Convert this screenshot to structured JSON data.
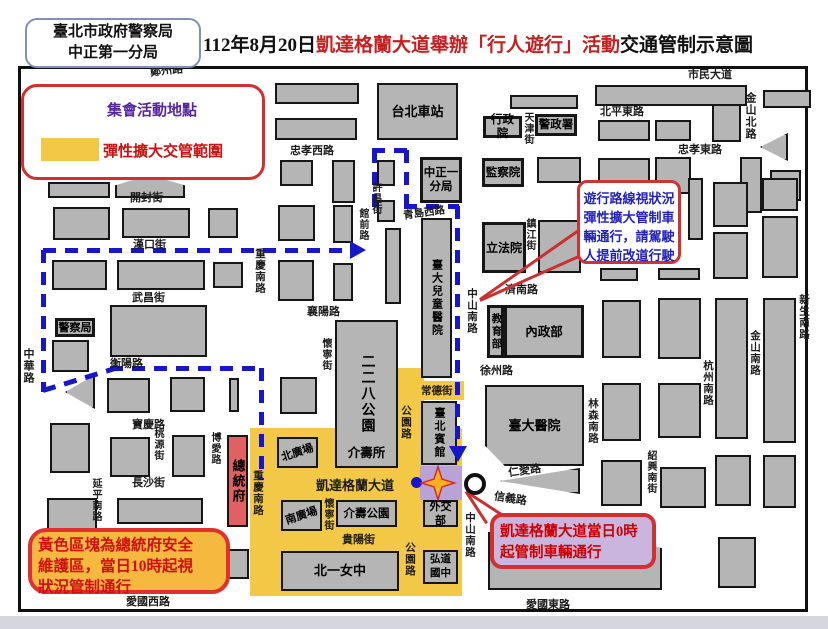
{
  "header": {
    "agency_line1": "臺北市政府警察局",
    "agency_line2": "中正第一分局",
    "title_prefix": "112年8月20日",
    "title_red": "凱達格蘭大道舉辦「行人遊行」活動",
    "title_suffix": "交通管制示意圖"
  },
  "legend": {
    "star_label": "集會活動地點",
    "zone_label": "彈性擴大交管範圍"
  },
  "callouts": {
    "route_note": [
      "遊行路線視狀況",
      "彈性擴大管制車",
      "輛通行，請駕駛",
      "人提前改道行駛"
    ],
    "yellow_note": [
      "黃色區塊為總統府安全",
      "維護區，當日10時起視",
      "狀況管制通行"
    ],
    "kdg_note": [
      "凱達格蘭大道當日0時",
      "起管制車輛通行"
    ]
  },
  "colors": {
    "control_zone_yellow": "#f3c846",
    "assembly_purple": "#b9a3d6",
    "president_red": "#e06161",
    "route_blue": "#1717c9",
    "callout_red": "#cc3333",
    "block_gray": "#b5b5b5"
  },
  "map": {
    "zones": [
      {
        "x": 250,
        "y": 428,
        "w": 212,
        "h": 168,
        "c": "#f3c846"
      },
      {
        "x": 394,
        "y": 368,
        "w": 30,
        "h": 118,
        "c": "#f3c846"
      },
      {
        "x": 420,
        "y": 381,
        "w": 44,
        "h": 19,
        "c": "#f3c846"
      },
      {
        "x": 420,
        "y": 466,
        "w": 42,
        "h": 34,
        "c": "#b9a3d6"
      }
    ],
    "blocks": [
      {
        "x": 48,
        "y": 182,
        "w": 62,
        "h": 16
      },
      {
        "x": 115,
        "y": 175,
        "w": 70,
        "h": 23,
        "kind": "tri-top"
      },
      {
        "x": 53,
        "y": 207,
        "w": 57,
        "h": 33
      },
      {
        "x": 122,
        "y": 208,
        "w": 68,
        "h": 30
      },
      {
        "x": 208,
        "y": 208,
        "w": 30,
        "h": 30
      },
      {
        "x": 52,
        "y": 260,
        "w": 55,
        "h": 30
      },
      {
        "x": 117,
        "y": 260,
        "w": 88,
        "h": 30
      },
      {
        "x": 213,
        "y": 262,
        "w": 30,
        "h": 26
      },
      {
        "x": 110,
        "y": 305,
        "w": 97,
        "h": 52
      },
      {
        "x": 52,
        "y": 340,
        "w": 37,
        "h": 32
      },
      {
        "x": 65,
        "y": 375,
        "w": 30,
        "h": 34,
        "kind": "tri-left"
      },
      {
        "x": 107,
        "y": 378,
        "w": 43,
        "h": 35
      },
      {
        "x": 170,
        "y": 377,
        "w": 35,
        "h": 35
      },
      {
        "x": 229,
        "y": 378,
        "w": 10,
        "h": 34
      },
      {
        "x": 50,
        "y": 423,
        "w": 40,
        "h": 50
      },
      {
        "x": 110,
        "y": 437,
        "w": 40,
        "h": 40
      },
      {
        "x": 172,
        "y": 435,
        "w": 33,
        "h": 42
      },
      {
        "x": 47,
        "y": 498,
        "w": 50,
        "h": 34
      },
      {
        "x": 117,
        "y": 498,
        "w": 86,
        "h": 26
      },
      {
        "x": 50,
        "y": 542,
        "w": 58,
        "h": 48
      },
      {
        "x": 120,
        "y": 532,
        "w": 84,
        "h": 54
      },
      {
        "x": 223,
        "y": 549,
        "w": 26,
        "h": 30
      },
      {
        "x": 275,
        "y": 83,
        "w": 84,
        "h": 21
      },
      {
        "x": 275,
        "y": 118,
        "w": 82,
        "h": 22
      },
      {
        "x": 280,
        "y": 160,
        "w": 33,
        "h": 26
      },
      {
        "x": 332,
        "y": 160,
        "w": 23,
        "h": 43
      },
      {
        "x": 377,
        "y": 160,
        "w": 18,
        "h": 26
      },
      {
        "x": 278,
        "y": 205,
        "w": 37,
        "h": 36
      },
      {
        "x": 333,
        "y": 205,
        "w": 20,
        "h": 38
      },
      {
        "x": 377,
        "y": 200,
        "w": 18,
        "h": 22
      },
      {
        "x": 385,
        "y": 228,
        "w": 16,
        "h": 76
      },
      {
        "x": 278,
        "y": 260,
        "w": 36,
        "h": 41
      },
      {
        "x": 333,
        "y": 263,
        "w": 20,
        "h": 38
      },
      {
        "x": 280,
        "y": 377,
        "w": 37,
        "h": 37
      },
      {
        "x": 510,
        "y": 95,
        "w": 68,
        "h": 14
      },
      {
        "x": 595,
        "y": 85,
        "w": 152,
        "h": 21
      },
      {
        "x": 763,
        "y": 90,
        "w": 48,
        "h": 18
      },
      {
        "x": 598,
        "y": 120,
        "w": 52,
        "h": 21
      },
      {
        "x": 655,
        "y": 120,
        "w": 36,
        "h": 21
      },
      {
        "x": 712,
        "y": 104,
        "w": 29,
        "h": 38
      },
      {
        "x": 537,
        "y": 157,
        "w": 44,
        "h": 26
      },
      {
        "x": 598,
        "y": 158,
        "w": 52,
        "h": 36
      },
      {
        "x": 655,
        "y": 157,
        "w": 36,
        "h": 37
      },
      {
        "x": 740,
        "y": 157,
        "w": 22,
        "h": 56
      },
      {
        "x": 770,
        "y": 170,
        "w": 31,
        "h": 31
      },
      {
        "x": 760,
        "y": 133,
        "w": 28,
        "h": 28,
        "kind": "tri-left"
      },
      {
        "x": 538,
        "y": 220,
        "w": 43,
        "h": 53
      },
      {
        "x": 688,
        "y": 178,
        "w": 15,
        "h": 62
      },
      {
        "x": 713,
        "y": 182,
        "w": 35,
        "h": 45
      },
      {
        "x": 762,
        "y": 178,
        "w": 36,
        "h": 33
      },
      {
        "x": 713,
        "y": 232,
        "w": 35,
        "h": 47
      },
      {
        "x": 762,
        "y": 216,
        "w": 36,
        "h": 62
      },
      {
        "x": 600,
        "y": 268,
        "w": 38,
        "h": 13
      },
      {
        "x": 658,
        "y": 268,
        "w": 42,
        "h": 12
      },
      {
        "x": 602,
        "y": 300,
        "w": 39,
        "h": 58
      },
      {
        "x": 658,
        "y": 298,
        "w": 43,
        "h": 61
      },
      {
        "x": 715,
        "y": 298,
        "w": 33,
        "h": 141
      },
      {
        "x": 763,
        "y": 298,
        "w": 33,
        "h": 145
      },
      {
        "x": 602,
        "y": 383,
        "w": 39,
        "h": 58
      },
      {
        "x": 658,
        "y": 383,
        "w": 43,
        "h": 55
      },
      {
        "x": 500,
        "y": 468,
        "w": 80,
        "h": 26,
        "kind": "tri-left"
      },
      {
        "x": 601,
        "y": 460,
        "w": 41,
        "h": 46
      },
      {
        "x": 660,
        "y": 467,
        "w": 46,
        "h": 41
      },
      {
        "x": 715,
        "y": 455,
        "w": 36,
        "h": 51
      },
      {
        "x": 763,
        "y": 455,
        "w": 33,
        "h": 53
      },
      {
        "x": 718,
        "y": 537,
        "w": 38,
        "h": 51
      },
      {
        "x": 488,
        "y": 532,
        "w": 174,
        "h": 58,
        "kind": "cut-tr",
        "label": "堂",
        "lpos": [
          30,
          42
        ]
      },
      {
        "x": 377,
        "y": 83,
        "w": 81,
        "h": 57,
        "label": "台北車站",
        "fs": 13
      },
      {
        "x": 420,
        "y": 157,
        "w": 42,
        "h": 46,
        "label": "中正一\n分局",
        "kind": "gov",
        "fs": 11.5
      },
      {
        "x": 483,
        "y": 116,
        "w": 39,
        "h": 22,
        "label": "行政院",
        "kind": "gov",
        "fs": 11.5
      },
      {
        "x": 535,
        "y": 114,
        "w": 42,
        "h": 22,
        "label": "警政署",
        "kind": "gov",
        "fs": 11.5
      },
      {
        "x": 482,
        "y": 158,
        "w": 42,
        "h": 29,
        "label": "監察院",
        "kind": "gov",
        "fs": 11.5
      },
      {
        "x": 482,
        "y": 222,
        "w": 44,
        "h": 51,
        "label": "立法院",
        "kind": "gov",
        "fs": 12
      },
      {
        "x": 487,
        "y": 305,
        "w": 17,
        "h": 53,
        "label": "教育部",
        "kind": "gov",
        "ls": "v",
        "fs": 10.5
      },
      {
        "x": 504,
        "y": 305,
        "w": 80,
        "h": 53,
        "label": "內政部",
        "kind": "gov",
        "fs": 12.5
      },
      {
        "x": 55,
        "y": 318,
        "w": 40,
        "h": 19,
        "label": "警察局",
        "kind": "gov",
        "fs": 11
      },
      {
        "x": 335,
        "y": 320,
        "w": 63,
        "h": 148,
        "label": "二二八公園",
        "ls": "v",
        "sub": "介壽所",
        "fs": 14
      },
      {
        "x": 421,
        "y": 218,
        "w": 31,
        "h": 160,
        "label": "臺大兒童醫院",
        "ls": "v",
        "fs": 11
      },
      {
        "x": 421,
        "y": 401,
        "w": 36,
        "h": 64,
        "label": "臺北賓館",
        "ls": "v",
        "fs": 11
      },
      {
        "x": 277,
        "y": 437,
        "w": 41,
        "h": 31,
        "label": "北廣場",
        "ls": "rot",
        "fs": 11
      },
      {
        "x": 281,
        "y": 500,
        "w": 41,
        "h": 31,
        "label": "南廣場",
        "ls": "rot",
        "fs": 11
      },
      {
        "x": 336,
        "y": 500,
        "w": 61,
        "h": 27,
        "label": "介壽公園",
        "fs": 11.5
      },
      {
        "x": 423,
        "y": 500,
        "w": 35,
        "h": 27,
        "label": "外交部",
        "fs": 11
      },
      {
        "x": 281,
        "y": 551,
        "w": 118,
        "h": 40,
        "label": "北一女中",
        "fs": 13
      },
      {
        "x": 423,
        "y": 550,
        "w": 35,
        "h": 34,
        "label": "弘道\n國中",
        "fs": 10.5
      },
      {
        "x": 485,
        "y": 385,
        "w": 99,
        "h": 81,
        "label": "臺大醫院",
        "kind": "cut-bl",
        "fs": 13
      },
      {
        "x": 227,
        "y": 435,
        "w": 21,
        "h": 92,
        "label": "總統府",
        "kind": "pres",
        "ls": "v",
        "fs": 13
      }
    ],
    "streets": [
      {
        "t": "鄭州路",
        "x": 150,
        "y": 62,
        "rot": -6
      },
      {
        "t": "市民大道",
        "x": 688,
        "y": 66
      },
      {
        "t": "忠孝西路",
        "x": 290,
        "y": 142
      },
      {
        "t": "北平東路",
        "x": 600,
        "y": 103
      },
      {
        "t": "忠孝東路",
        "x": 678,
        "y": 141
      },
      {
        "t": "金山北路",
        "x": 742,
        "y": 92,
        "d": "v"
      },
      {
        "t": "天津街",
        "x": 520,
        "y": 112,
        "d": "v",
        "sz": 10
      },
      {
        "t": "許昌街",
        "x": 368,
        "y": 182,
        "d": "v",
        "sz": 10
      },
      {
        "t": "開封街",
        "x": 130,
        "y": 189
      },
      {
        "t": "漢口街",
        "x": 133,
        "y": 236
      },
      {
        "t": "青島西路",
        "x": 403,
        "y": 205,
        "rot": -8,
        "sz": 10.5
      },
      {
        "t": "青島東路",
        "x": 588,
        "y": 196
      },
      {
        "t": "武昌街",
        "x": 132,
        "y": 289
      },
      {
        "t": "衡陽路",
        "x": 110,
        "y": 355
      },
      {
        "t": "襄陽路",
        "x": 307,
        "y": 303
      },
      {
        "t": "濟南路",
        "x": 505,
        "y": 281
      },
      {
        "t": "寶慶路",
        "x": 132,
        "y": 416
      },
      {
        "t": "徐州路",
        "x": 480,
        "y": 362
      },
      {
        "t": "常德街",
        "x": 421,
        "y": 383,
        "sz": 10.5
      },
      {
        "t": "桃源街",
        "x": 150,
        "y": 428,
        "d": "v",
        "sz": 10
      },
      {
        "t": "長沙街",
        "x": 132,
        "y": 474
      },
      {
        "t": "仁愛路",
        "x": 508,
        "y": 462,
        "rot": -8
      },
      {
        "t": "信義路",
        "x": 494,
        "y": 490,
        "rot": 9
      },
      {
        "t": "貴陽街",
        "x": 342,
        "y": 531
      },
      {
        "t": "愛國西路",
        "x": 126,
        "y": 593
      },
      {
        "t": "愛國東路",
        "x": 526,
        "y": 596
      },
      {
        "t": "凱達格蘭大道",
        "x": 316,
        "y": 475,
        "sz": 13
      },
      {
        "t": "中華路",
        "x": 20,
        "y": 348,
        "d": "v"
      },
      {
        "t": "延平南路",
        "x": 88,
        "y": 478,
        "d": "v",
        "sz": 10
      },
      {
        "t": "重慶南路",
        "x": 252,
        "y": 248,
        "d": "v",
        "sz": 10.5
      },
      {
        "t": "重慶南路",
        "x": 250,
        "y": 470,
        "d": "v",
        "sz": 10.5
      },
      {
        "t": "博愛路",
        "x": 207,
        "y": 432,
        "d": "v",
        "sz": 10
      },
      {
        "t": "懷寧街",
        "x": 318,
        "y": 338,
        "d": "v",
        "sz": 10
      },
      {
        "t": "懷寧街",
        "x": 320,
        "y": 498,
        "d": "v",
        "sz": 10
      },
      {
        "t": "館前路",
        "x": 355,
        "y": 208,
        "d": "v",
        "sz": 10
      },
      {
        "t": "公園路",
        "x": 398,
        "y": 405,
        "d": "v",
        "sz": 10.5
      },
      {
        "t": "公園路",
        "x": 402,
        "y": 542,
        "d": "v",
        "sz": 10.5
      },
      {
        "t": "中山南路",
        "x": 464,
        "y": 288,
        "d": "v",
        "sz": 10.5
      },
      {
        "t": "中山南路",
        "x": 462,
        "y": 512,
        "d": "v",
        "sz": 10.5
      },
      {
        "t": "林森南路",
        "x": 585,
        "y": 398,
        "d": "v",
        "sz": 10.5
      },
      {
        "t": "杭州南路",
        "x": 700,
        "y": 360,
        "d": "v",
        "sz": 10.5
      },
      {
        "t": "金山南路",
        "x": 747,
        "y": 330,
        "d": "v",
        "sz": 10.5
      },
      {
        "t": "新生南路",
        "x": 796,
        "y": 294,
        "d": "v",
        "sz": 10.5
      },
      {
        "t": "紹興南街",
        "x": 643,
        "y": 450,
        "d": "v",
        "sz": 10
      },
      {
        "t": "鎮江街",
        "x": 522,
        "y": 218,
        "d": "v",
        "sz": 10
      }
    ],
    "route": {
      "segments": [
        {
          "o": "h",
          "x": 43,
          "y": 248,
          "len": 310
        },
        {
          "o": "v",
          "x": 41,
          "y": 250,
          "len": 142
        },
        {
          "o": "r",
          "x": 43,
          "y": 388,
          "len": 74,
          "deg": -17
        },
        {
          "o": "h",
          "x": 110,
          "y": 366,
          "len": 152
        },
        {
          "o": "v",
          "x": 259,
          "y": 368,
          "len": 112
        },
        {
          "o": "v",
          "x": 372,
          "y": 150,
          "len": 66
        },
        {
          "o": "v",
          "x": 404,
          "y": 150,
          "len": 56
        },
        {
          "o": "h",
          "x": 372,
          "y": 148,
          "len": 37
        },
        {
          "o": "h",
          "x": 404,
          "y": 204,
          "len": 55
        },
        {
          "o": "v",
          "x": 455,
          "y": 206,
          "len": 242
        }
      ],
      "arrows": [
        {
          "t": "r",
          "x": 350,
          "y": 241
        },
        {
          "t": "d",
          "x": 449,
          "y": 446
        }
      ],
      "dot": {
        "x": 411,
        "y": 477
      }
    },
    "pointers": [
      {
        "x": 480,
        "y": 298,
        "len": 133,
        "deg": -35
      },
      {
        "x": 480,
        "y": 299,
        "len": 122,
        "deg": -24
      },
      {
        "x": 466,
        "y": 490,
        "len": 44,
        "deg": 33
      },
      {
        "x": 466,
        "y": 490,
        "len": 38,
        "deg": 57
      }
    ],
    "stars": [
      {
        "x": 50,
        "y": 89,
        "s": 44
      },
      {
        "x": 419,
        "y": 464,
        "s": 38
      }
    ],
    "circle": {
      "x": 464,
      "y": 473,
      "d": 22
    }
  }
}
